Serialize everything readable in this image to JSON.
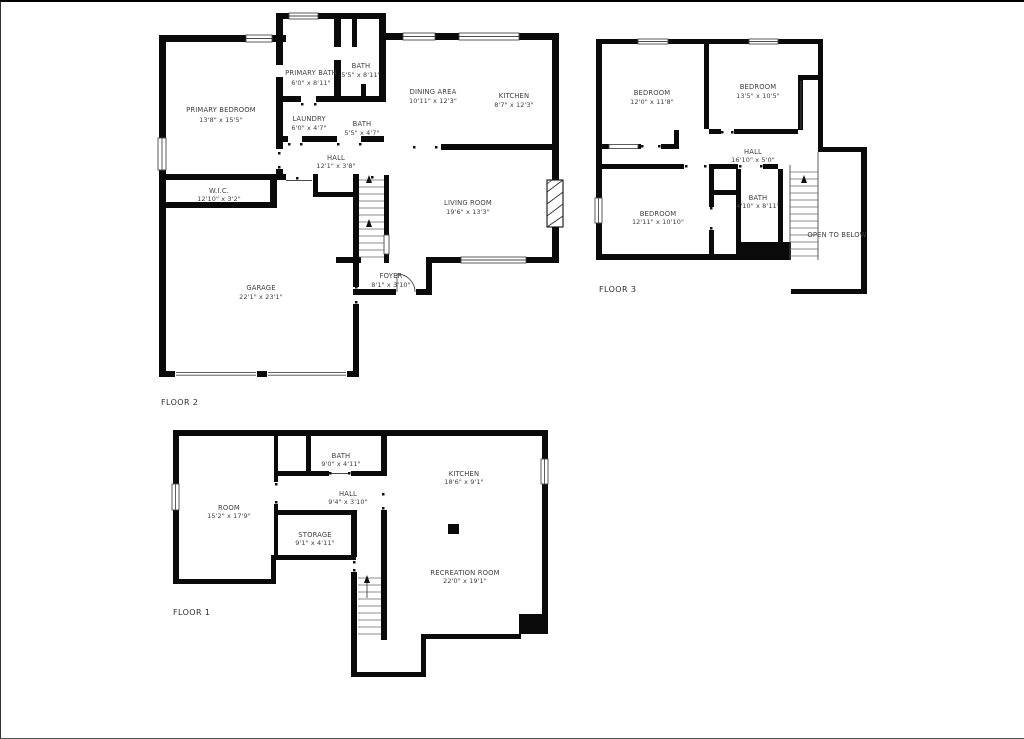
{
  "colors": {
    "wall": "#0a0a0a",
    "text": "#3e3e3e",
    "background": "#ffffff"
  },
  "floors": [
    {
      "label": "FLOOR 2",
      "rooms": [
        {
          "name": "PRIMARY BEDROOM",
          "dims": "13'8\" x 15'5\""
        },
        {
          "name": "PRIMARY BATH",
          "dims": "6'0\" x 8'11\""
        },
        {
          "name": "BATH",
          "dims": "5'5\" x 8'11\""
        },
        {
          "name": "LAUNDRY",
          "dims": "6'0\" x 4'7\""
        },
        {
          "name": "BATH",
          "dims": "5'5\" x 4'7\""
        },
        {
          "name": "HALL",
          "dims": "12'1\" x 3'8\""
        },
        {
          "name": "DINING AREA",
          "dims": "10'11\" x 12'3\""
        },
        {
          "name": "KITCHEN",
          "dims": "8'7\" x 12'3\""
        },
        {
          "name": "W.I.C.",
          "dims": "12'10\" x 3'2\""
        },
        {
          "name": "LIVING ROOM",
          "dims": "19'6\" x 13'3\""
        },
        {
          "name": "GARAGE",
          "dims": "22'1\" x 23'1\""
        },
        {
          "name": "FOYER",
          "dims": "8'1\" x 3'10\""
        }
      ]
    },
    {
      "label": "FLOOR 3",
      "note": "OPEN TO BELOW",
      "rooms": [
        {
          "name": "BEDROOM",
          "dims": "12'0\" x 11'8\""
        },
        {
          "name": "BEDROOM",
          "dims": "13'5\" x 10'5\""
        },
        {
          "name": "HALL",
          "dims": "16'10\" x 5'0\""
        },
        {
          "name": "BEDROOM",
          "dims": "12'11\" x 10'10\""
        },
        {
          "name": "BATH",
          "dims": "4'10\" x 8'11\""
        }
      ]
    },
    {
      "label": "FLOOR 1",
      "rooms": [
        {
          "name": "BATH",
          "dims": "9'0\" x 4'11\""
        },
        {
          "name": "KITCHEN",
          "dims": "18'6\" x 9'1\""
        },
        {
          "name": "ROOM",
          "dims": "15'2\" x 17'9\""
        },
        {
          "name": "HALL",
          "dims": "9'4\" x 3'10\""
        },
        {
          "name": "STORAGE",
          "dims": "9'1\" x 4'11\""
        },
        {
          "name": "RECREATION ROOM",
          "dims": "22'0\" x 19'1\""
        }
      ]
    }
  ]
}
